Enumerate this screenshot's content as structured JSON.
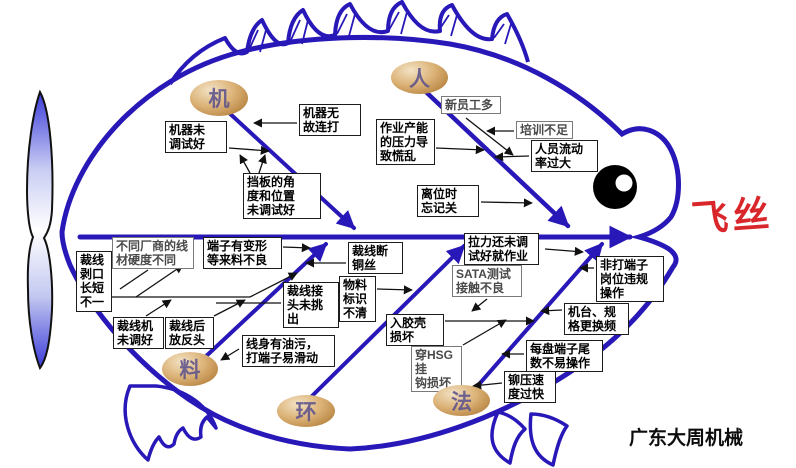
{
  "effect": {
    "label": "飞丝"
  },
  "watermark": "广东大周机械",
  "colors": {
    "branch_blue": "#2818b8",
    "effect_red": "#d9262b",
    "oval_tan": "#dcb277",
    "box_border": "#1c1c1c"
  },
  "categories": [
    {
      "id": "machine",
      "label": "机"
    },
    {
      "id": "man",
      "label": "人"
    },
    {
      "id": "material",
      "label": "料"
    },
    {
      "id": "environment",
      "label": "环"
    },
    {
      "id": "method",
      "label": "法"
    }
  ],
  "boxes": [
    {
      "id": "machine-not-tuned",
      "text": "机器未\n调试好"
    },
    {
      "id": "machine-random-strike",
      "text": "机器无\n故连打"
    },
    {
      "id": "baffle-angle-position",
      "text": "挡板的角\n度和位置\n未调试好"
    },
    {
      "id": "many-new-employees",
      "text": "新员工多"
    },
    {
      "id": "insufficient-training",
      "text": "培训不足"
    },
    {
      "id": "high-turnover",
      "text": "人员流动\n率过大"
    },
    {
      "id": "capacity-pressure-panic",
      "text": "作业产能\n的压力导\n致慌乱"
    },
    {
      "id": "forget-to-switch-off",
      "text": "离位时\n忘记关"
    },
    {
      "id": "wire-hardness-differs",
      "text": "不同厂商的线\n材硬度不同"
    },
    {
      "id": "terminal-deformed-incoming",
      "text": "端子有变形\n等来料不良"
    },
    {
      "id": "strip-length-uneven",
      "text": "裁线\n剥口\n长短\n不一"
    },
    {
      "id": "cutter-not-adjusted",
      "text": "裁线机\n未调好"
    },
    {
      "id": "reversed-after-cutting",
      "text": "裁线后\n放反头"
    },
    {
      "id": "copper-wire-broken",
      "text": "裁线断\n铜丝"
    },
    {
      "id": "material-label-unclear",
      "text": "物料\n标识\n不清"
    },
    {
      "id": "joints-not-picked-out",
      "text": "裁线接\n头未挑\n出"
    },
    {
      "id": "oily-wire-slips",
      "text": "线身有油污，\n打端子易滑动"
    },
    {
      "id": "shell-insert-damage",
      "text": "入胶壳\n损坏"
    },
    {
      "id": "hsg-hook-damage",
      "text": "穿HSG挂\n钩损坏"
    },
    {
      "id": "sata-test-bad-contact",
      "text": "SATA测试\n接触不良"
    },
    {
      "id": "work-before-tension-tuned",
      "text": "拉力还未调\n试好就作业"
    },
    {
      "id": "non-crimp-post-violation",
      "text": "非打端子\n岗位违规\n操作"
    },
    {
      "id": "frequent-machine-spec-change",
      "text": "机台、规\n格更换频"
    },
    {
      "id": "reel-tail-hard-to-handle",
      "text": "每盘端子尾\n数不易操作"
    },
    {
      "id": "crimp-speed-too-fast",
      "text": "铆压速\n度过快"
    }
  ]
}
